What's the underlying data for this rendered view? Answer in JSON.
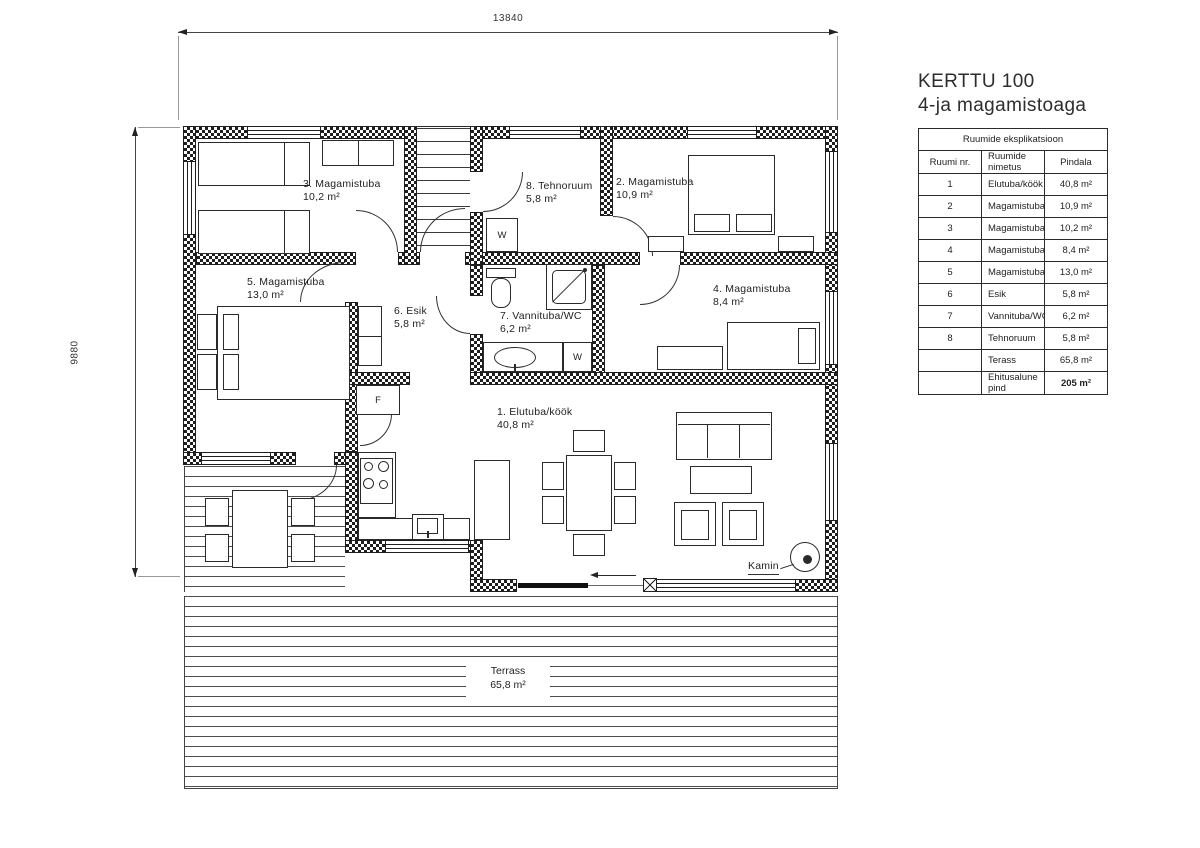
{
  "brand": {
    "line1": "KERTTU 100",
    "line2": "4-ja magamistoaga"
  },
  "dimensions": {
    "top": "13840",
    "left": "9880"
  },
  "rooms": {
    "r1": {
      "name": "1. Elutuba/köök",
      "area": "40,8 m²"
    },
    "r2": {
      "name": "2. Magamistuba",
      "area": "10,9 m²"
    },
    "r3": {
      "name": "3. Magamistuba",
      "area": "10,2 m²"
    },
    "r4": {
      "name": "4. Magamistuba",
      "area": "8,4 m²"
    },
    "r5": {
      "name": "5. Magamistuba",
      "area": "13,0 m²"
    },
    "r6": {
      "name": "6. Esik",
      "area": "5,8 m²"
    },
    "r7": {
      "name": "7. Vannituba/WC",
      "area": "6,2 m²"
    },
    "r8": {
      "name": "8. Tehnoruum",
      "area": "5,8 m²"
    }
  },
  "terrace": {
    "name": "Terrass",
    "area": "65,8 m²"
  },
  "annotations": {
    "fireplace": "Kamin",
    "washer": "W",
    "fridge": "F"
  },
  "legend_table": {
    "title": "Ruumide eksplikatsioon",
    "columns": {
      "nr": "Ruumi nr.",
      "name": "Ruumide nimetus",
      "area": "Pindala"
    },
    "rows": [
      {
        "nr": "1",
        "name": "Elutuba/köök",
        "area": "40,8 m²"
      },
      {
        "nr": "2",
        "name": "Magamistuba",
        "area": "10,9 m²"
      },
      {
        "nr": "3",
        "name": "Magamistuba",
        "area": "10,2 m²"
      },
      {
        "nr": "4",
        "name": "Magamistuba",
        "area": "8,4 m²"
      },
      {
        "nr": "5",
        "name": "Magamistuba",
        "area": "13,0 m²"
      },
      {
        "nr": "6",
        "name": "Esik",
        "area": "5,8 m²"
      },
      {
        "nr": "7",
        "name": "Vannituba/WC",
        "area": "6,2 m²"
      },
      {
        "nr": "8",
        "name": "Tehnoruum",
        "area": "5,8 m²"
      },
      {
        "nr": "",
        "name": "Terass",
        "area": "65,8 m²"
      },
      {
        "nr": "",
        "name": "Ehitusalune pind",
        "area": "205 m²"
      }
    ]
  }
}
